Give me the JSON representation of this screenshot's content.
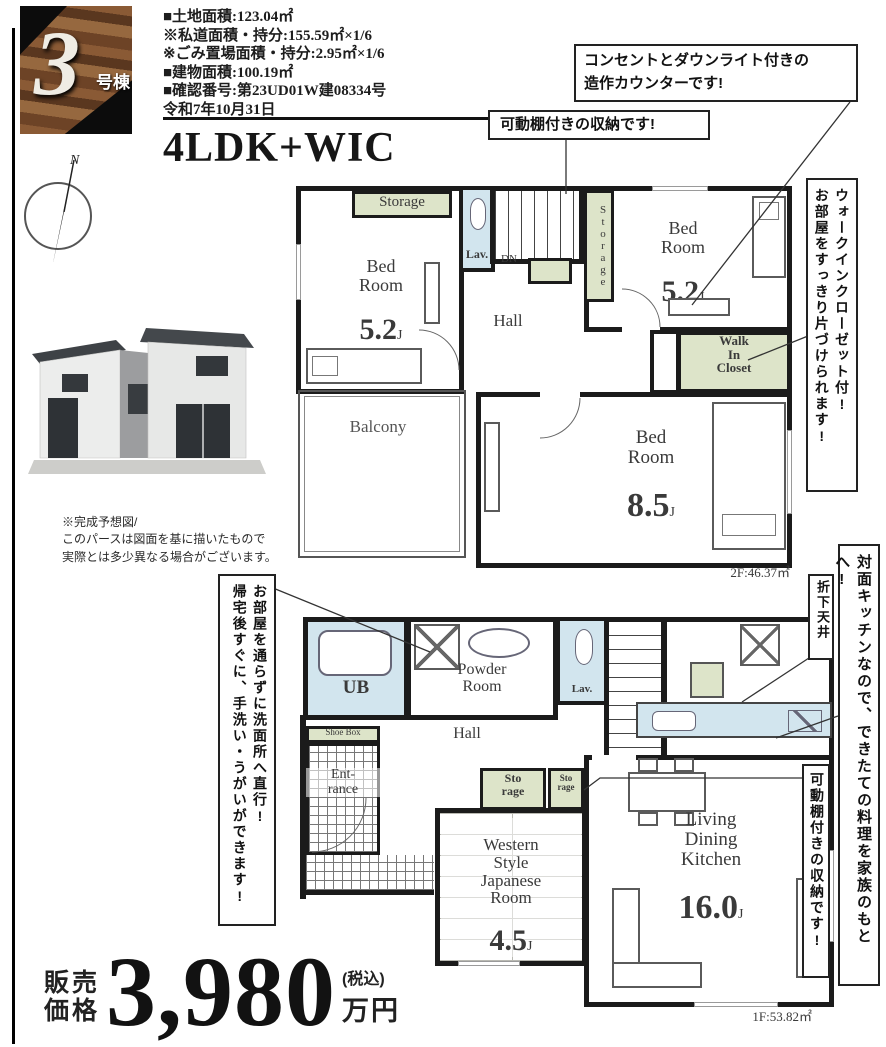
{
  "badge": {
    "number": "3",
    "suffix": "号棟"
  },
  "info_lines": [
    "■土地面積:123.04㎡",
    "  ※私道面積・持分:155.59㎡×1/6",
    "  ※ごみ置場面積・持分:2.95㎡×1/6",
    "■建物面積:100.19㎡",
    "■確認番号:第23UD01W建08334号",
    "  令和7年10月31日"
  ],
  "plan_type": "4LDK+WIC",
  "compass": {
    "north": "N"
  },
  "house_caption": "※完成予想図/\nこのパースは図面を基に描いたもので\n実際とは多少異なる場合がございます。",
  "callouts": {
    "counter": "コンセントとダウンライト付きの\n造作カウンターです!",
    "shelf_2f": "可動棚付きの収納です!",
    "wic": "ウォークインクローゼット付!\nお部屋をすっきり片づけられます!",
    "washroom": "お部屋を通らずに洗面所へ直行!\n帰宅後すぐに、手洗い・うがいができます!",
    "ceiling": "折下天井",
    "kitchen": "対面キッチンなので、できたての料理を家族のもとへ!",
    "shelf_1f": "可動棚付きの収納です!"
  },
  "floor2": {
    "storage_left": "Storage",
    "lav": "Lav.",
    "dn": "DN",
    "storage_right": "Storage",
    "hall": "Hall",
    "bedroom_left": {
      "name": "Bed\nRoom",
      "size": "5.2",
      "unit": "J"
    },
    "bedroom_right": {
      "name": "Bed\nRoom",
      "size": "5.2",
      "unit": "J"
    },
    "wic": "Walk\nIn\nCloset",
    "balcony": "Balcony",
    "bedroom_main": {
      "name": "Bed\nRoom",
      "size": "8.5",
      "unit": "J"
    },
    "area": "2F:46.37㎡"
  },
  "floor1": {
    "ub": "UB",
    "powder": "Powder\nRoom",
    "lav": "Lav.",
    "hall": "Hall",
    "shoebox": "Shoe Box",
    "entrance": "Ent-\nrance",
    "storage_a": "Sto\nrage",
    "storage_b": "Sto\nrage",
    "japanese_room": {
      "name": "Western\nStyle\nJapanese\nRoom",
      "size": "4.5",
      "unit": "J"
    },
    "ldk": {
      "name": "Living\nDining\nKitchen",
      "size": "16.0",
      "unit": "J"
    },
    "area": "1F:53.82㎡"
  },
  "price": {
    "label": "販売\n価格",
    "amount": "3,980",
    "tax": "(税込)",
    "unit": "万円"
  },
  "colors": {
    "storage_green": "#dde4c9",
    "fixture_blue": "#d2e5ee",
    "wall": "#1b1b1b"
  }
}
